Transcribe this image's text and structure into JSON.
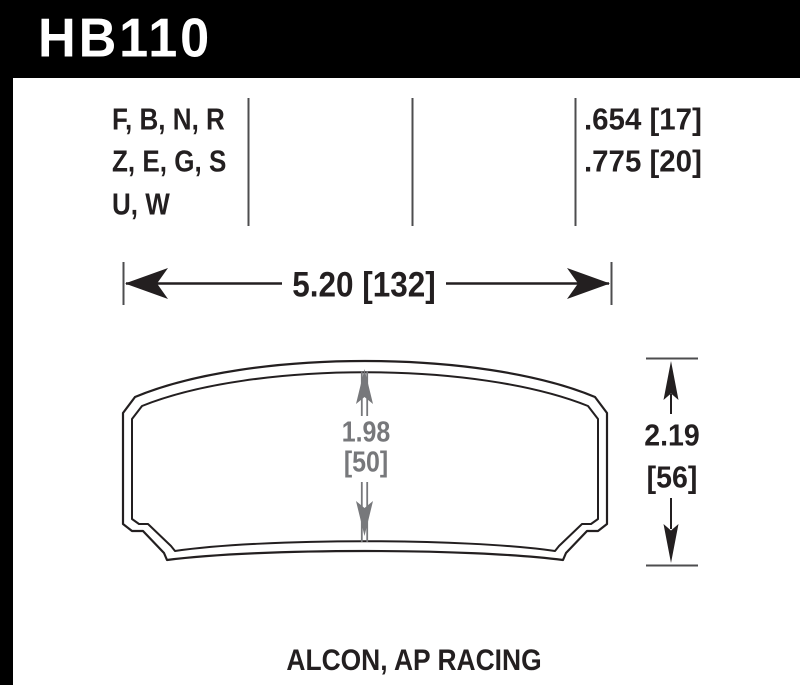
{
  "part_header": {
    "part_number": "HB110"
  },
  "spec_table": {
    "compound_rows": [
      "F, B, N, R",
      "Z, E, G, S",
      "U, W"
    ],
    "thickness_rows": [
      ".654 [17]",
      ".775 [20]"
    ]
  },
  "dimensions": {
    "overall_width": "5.20 [132]",
    "pad_height_in": "1.98",
    "pad_height_mm": "[50]",
    "overall_height_in": "2.19",
    "overall_height_mm": "[56]"
  },
  "footer": {
    "applications": "ALCON, AP RACING"
  },
  "colors": {
    "header_bg": "#000000",
    "header_text": "#ffffff",
    "line_black": "#231f20",
    "dim_gray": "#77787b",
    "tick_gray": "#4d4d4f"
  }
}
